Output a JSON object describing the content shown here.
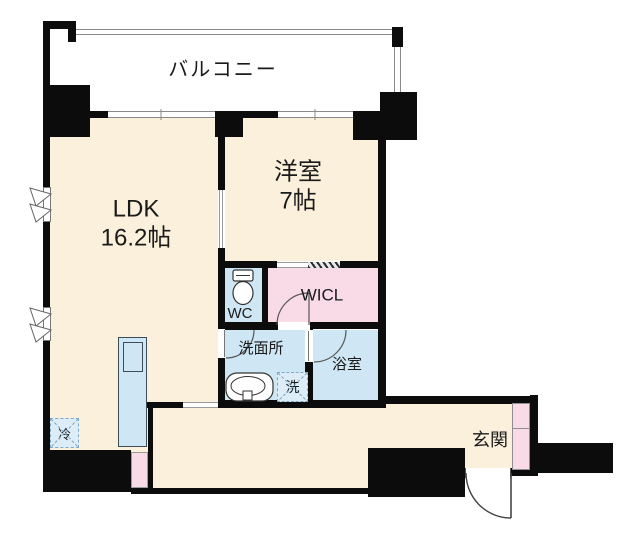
{
  "floorplan": {
    "balcony": {
      "label": "バルコニー"
    },
    "ldk": {
      "label": "LDK",
      "area": "16.2帖"
    },
    "western_room": {
      "label": "洋室",
      "area": "7帖"
    },
    "wc": {
      "label": "WC"
    },
    "wicl": {
      "label": "WICL"
    },
    "washroom": {
      "label": "洗面所"
    },
    "bathroom": {
      "label": "浴室"
    },
    "entrance": {
      "label": "玄関"
    },
    "refrigerator": {
      "label": "冷"
    },
    "washing_machine": {
      "label": "洗"
    }
  },
  "colors": {
    "floor": "#faf0db",
    "wet": "#cfe7f4",
    "closet": "#f8dbe7",
    "wall": "#0c0c0c",
    "line": "#8a8a8a"
  }
}
